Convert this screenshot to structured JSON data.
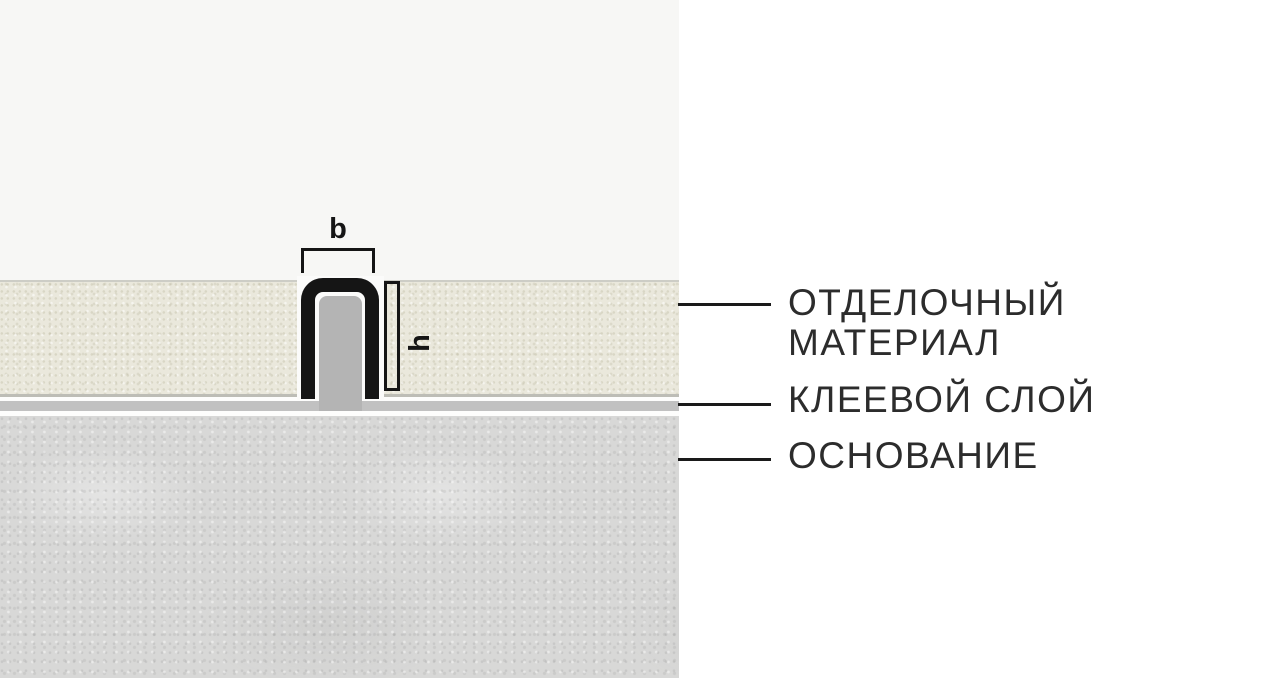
{
  "dimensions": {
    "width_label": "b",
    "height_label": "h"
  },
  "callouts": {
    "finish": {
      "lines": [
        "ОТДЕЛОЧНЫЙ",
        "МАТЕРИАЛ"
      ]
    },
    "adhesive": {
      "lines": [
        "КЛЕЕВОЙ СЛОЙ"
      ]
    },
    "base": {
      "lines": [
        "ОСНОВАНИЕ"
      ]
    }
  },
  "colors": {
    "panel_left_bg": "#f7f7f5",
    "panel_right_bg": "#ffffff",
    "finish_layer": "#eae8dc",
    "adhesive_layer": "#c1c1c1",
    "base_layer": "#d8d8d7",
    "profile": "#151515",
    "joint_filler": "#b4b4b4",
    "label_text": "#2c2c2c",
    "callout_line": "#1a1a1a"
  }
}
